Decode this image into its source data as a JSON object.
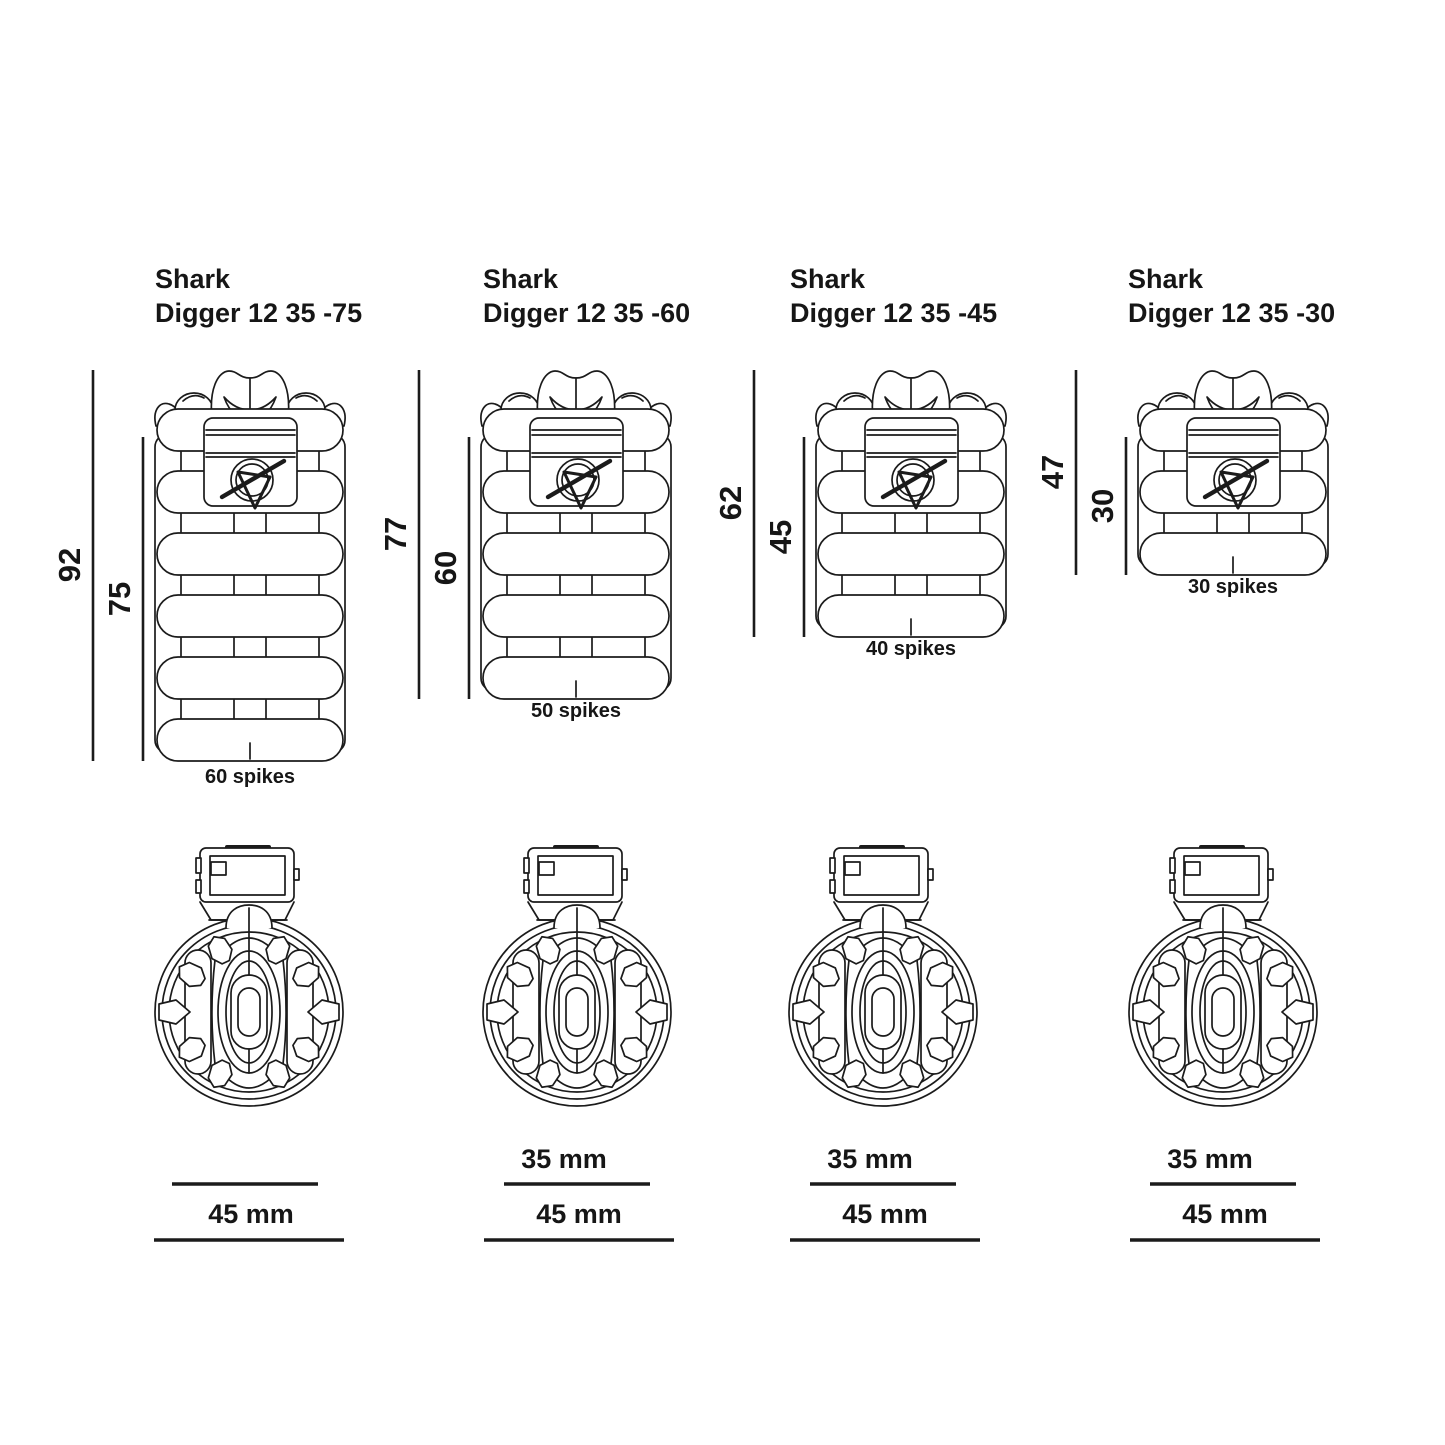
{
  "page": {
    "background": "#ffffff",
    "ink": "#1b1b1b",
    "drawing_type": "product dimension diagram"
  },
  "products": [
    {
      "title_line1": "Shark",
      "title_line2": "Digger 12 35 -75",
      "overall_height": "92",
      "cage_height": "75",
      "spikes_label": "60 spikes",
      "rings": 6,
      "front_inner_diameter": null,
      "front_outer_diameter": "45 mm"
    },
    {
      "title_line1": "Shark",
      "title_line2": "Digger 12 35 -60",
      "overall_height": "77",
      "cage_height": "60",
      "spikes_label": "50 spikes",
      "rings": 5,
      "front_inner_diameter": "35 mm",
      "front_outer_diameter": "45 mm"
    },
    {
      "title_line1": "Shark",
      "title_line2": "Digger 12 35 -45",
      "overall_height": "62",
      "cage_height": "45",
      "spikes_label": "40 spikes",
      "rings": 4,
      "front_inner_diameter": "35 mm",
      "front_outer_diameter": "45 mm"
    },
    {
      "title_line1": "Shark",
      "title_line2": "Digger 12 35 -30",
      "overall_height": "47",
      "cage_height": "30",
      "spikes_label": "30 spikes",
      "rings": 3,
      "front_inner_diameter": "35 mm",
      "front_outer_diameter": "45 mm"
    }
  ]
}
